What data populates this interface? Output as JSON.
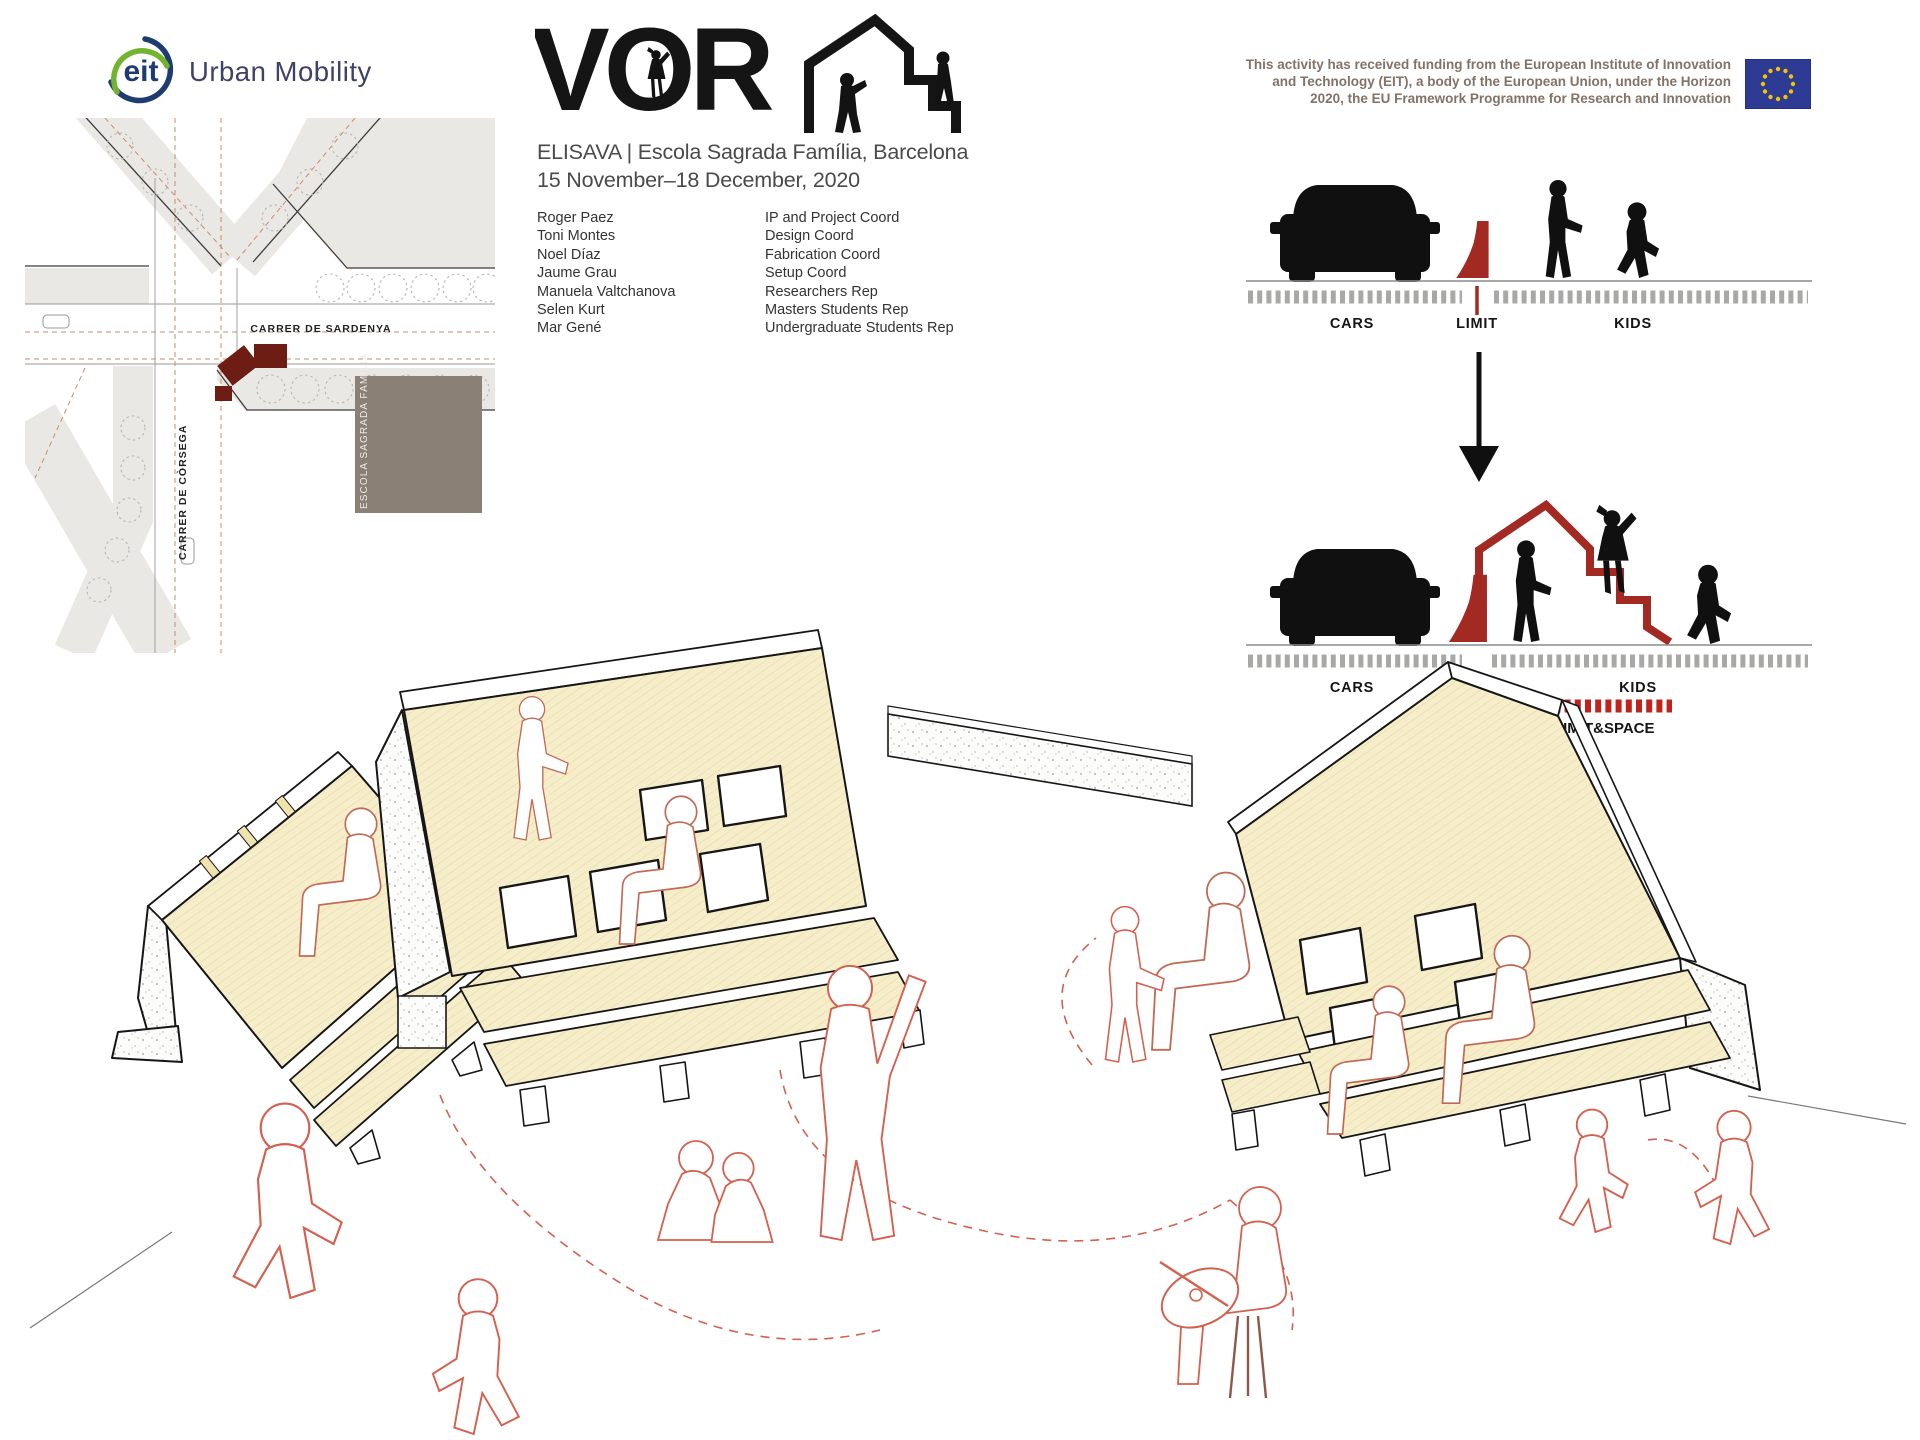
{
  "header": {
    "eit_logo": {
      "circle_text": "eit",
      "wordmark": "Urban Mobility"
    },
    "funding": {
      "text": "This activity has received funding from the European Institute of Innovation and Technology (EIT), a body of the European Union, under the Horizon 2020, the EU Framework Programme for Research and Innovation"
    }
  },
  "title_block": {
    "logo_text": "VOR",
    "venue": "ELISAVA | Escola Sagrada Família, Barcelona",
    "dates": "15 November–18 December, 2020",
    "credits": [
      {
        "name": "Roger Paez",
        "role": "IP and Project Coord"
      },
      {
        "name": "Toni Montes",
        "role": "Design Coord"
      },
      {
        "name": "Noel Díaz",
        "role": "Fabrication Coord"
      },
      {
        "name": "Jaume Grau",
        "role": "Setup Coord"
      },
      {
        "name": "Manuela Valtchanova",
        "role": "Researchers Rep"
      },
      {
        "name": "Selen Kurt",
        "role": "Masters Students Rep"
      },
      {
        "name": "Mar Gené",
        "role": "Undergraduate Students Rep"
      }
    ]
  },
  "map": {
    "street_horizontal": "CARRER DE SARDENYA",
    "street_vertical": "CARRER DE CÒRSEGA",
    "building_label": "ESCOLA SAGRADA FAMÍLIA"
  },
  "diagrams": {
    "before": {
      "label_cars": "CARS",
      "label_limit": "LIMIT",
      "label_kids": "KIDS"
    },
    "after": {
      "label_cars": "CARS",
      "label_kids": "KIDS",
      "caption": "VORA: LIMIT&SPACE"
    }
  },
  "colors": {
    "accent_red": "#a32a22",
    "dark_red": "#6e1d14",
    "bright_red": "#c0231c",
    "eu_blue": "#2e3b94",
    "panel_yellow": "#f6eecb",
    "eit_navy": "#1e3c6f",
    "eit_green": "#72b42e"
  }
}
